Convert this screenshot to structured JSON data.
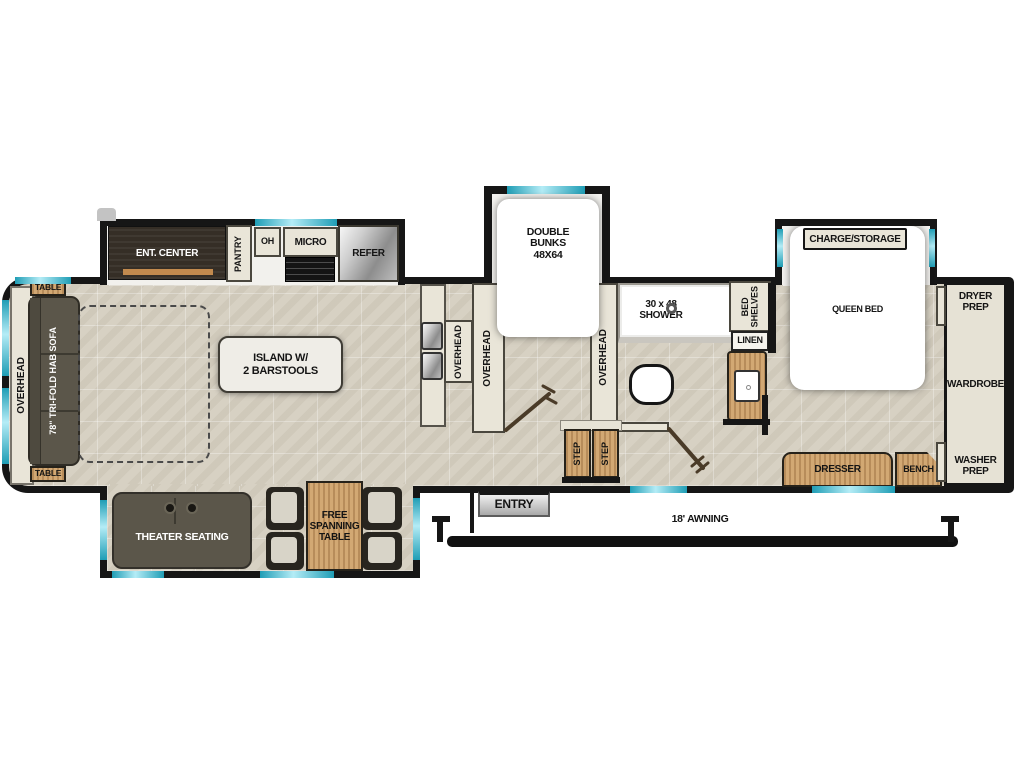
{
  "colors": {
    "wall": "#161616",
    "floor": "#d7d1c3",
    "window_accent": "#3fc3d9",
    "wood": "#d2a873",
    "dark_furniture": "#5b564a",
    "cabinet": "#e9e5d8"
  },
  "front": {
    "overhead": "OVERHEAD",
    "table_top": "TABLE",
    "sofa": "78\" TRI-FOLD HAB SOFA",
    "table_bottom": "TABLE"
  },
  "kitchen_slide": {
    "ent_center": "ENT. CENTER",
    "pantry": "PANTRY",
    "oh": "OH",
    "micro": "MICRO",
    "refer": "REFER"
  },
  "kitchen": {
    "island": "ISLAND W/\n2 BARSTOOLS",
    "overhead_counter": "OVERHEAD",
    "overhead_left_divider": "OVERHEAD",
    "overhead_right_divider": "OVERHEAD"
  },
  "bunk_room": {
    "double_bunks": "DOUBLE\nBUNKS\n48X64"
  },
  "bathroom": {
    "shower": "30 x 48\nSHOWER",
    "bed_shelves": "BED\nSHELVES",
    "linen": "LINEN"
  },
  "bedroom": {
    "charge_storage": "CHARGE/STORAGE",
    "queen_bed": "QUEEN BED",
    "dresser": "DRESSER",
    "bench": "BENCH"
  },
  "rear_closet": {
    "dryer_prep": "DRYER\nPREP",
    "wardrobe": "WARDROBE",
    "washer_prep": "WASHER\nPREP"
  },
  "entry": {
    "step_left": "STEP",
    "step_right": "STEP",
    "entry_label": "ENTRY",
    "awning": "18' AWNING"
  },
  "bottom_slide": {
    "theater_seating": "THEATER SEATING",
    "free_table": "FREE\nSPANNING\nTABLE"
  }
}
